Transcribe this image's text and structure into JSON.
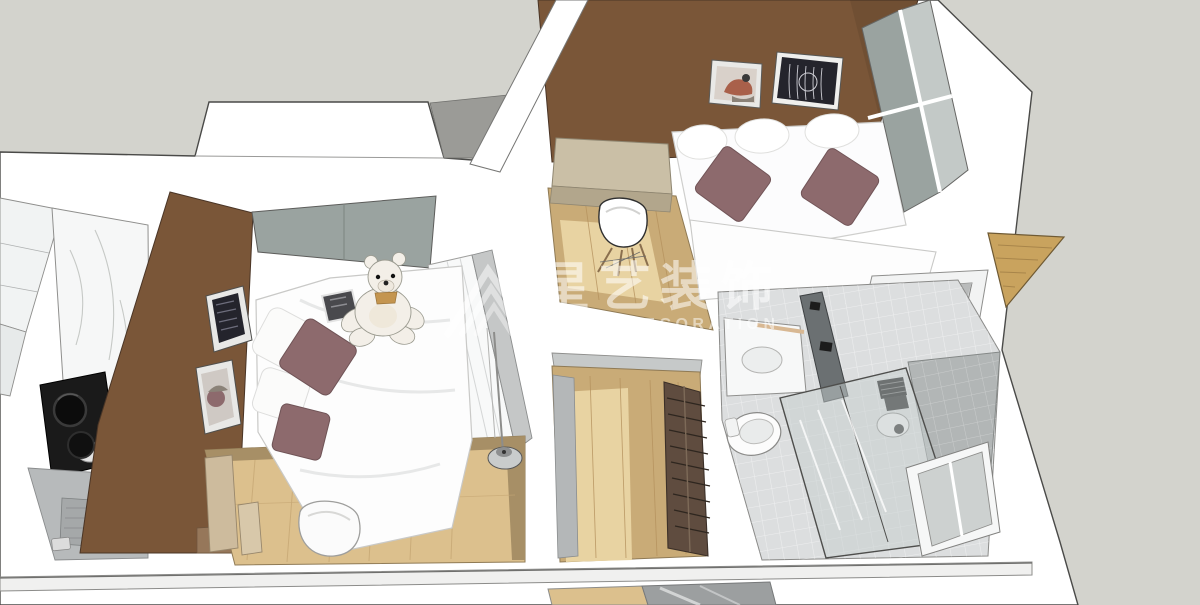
{
  "scene": {
    "description": "3D top-down dollhouse render of a small apartment interior",
    "view": "aerial perspective, walls cut at top, SketchUp style",
    "rooms": [
      "kitchen",
      "bedroom",
      "living-room",
      "hallway",
      "bathroom",
      "balcony-utility"
    ],
    "objects": [
      "bed",
      "teddy-bear",
      "mauve-pillows",
      "wardrobe",
      "floor-lamp",
      "art-frames",
      "sofa",
      "desk",
      "shell-chair",
      "coffee-table",
      "cooktop-with-pots",
      "marble-counter",
      "washbasin",
      "toilet",
      "shower-glass",
      "three-hole-counter",
      "wood-floors",
      "slatted-shelf"
    ]
  },
  "watermark": {
    "brand_cn": "星艺装饰",
    "brand_en": "XINGYI DECORATION",
    "logo": "xingyi-house-logo"
  },
  "colors": {
    "bg": "#d3d3cd",
    "wall_white": "#ffffff",
    "wall_gray": "#c5c7c7",
    "bay_shadow": "#9b9b97",
    "accent_brown": "#7a5638",
    "accent_brown_light": "#96775a",
    "wood": "#dcc08d",
    "wood_mid": "#c9ab77",
    "wood_light": "#e8d3a2",
    "wood_dark": "#a78f66",
    "wood_balcony": "#c9a35e",
    "mauve": "#8d6a6d",
    "art_dark": "#24242c",
    "beige": "#cabfa6",
    "beige_dark": "#b2a68c",
    "tile": "#dcdedf",
    "tile_dark": "#b2b6b6",
    "glass": "#9aa3a0",
    "glass_light": "#c3c9c7",
    "cooktop_black": "#1a1a1a",
    "shelf_brown": "#5f4c3f",
    "marble": "#f6f7f7",
    "plush": "#f3efe8",
    "watermark": "rgba(255,255,255,0.55)",
    "watermark_dim": "rgba(255,255,255,0.5)"
  }
}
